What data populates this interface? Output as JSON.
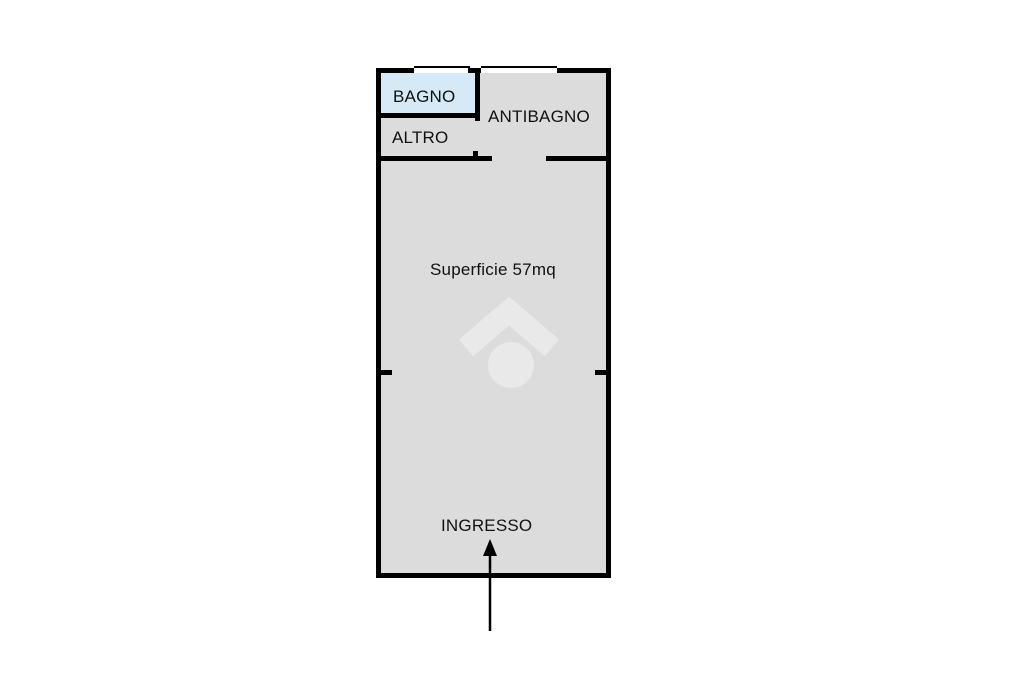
{
  "floorplan": {
    "labels": {
      "bagno": "BAGNO",
      "antibagno": "ANTIBAGNO",
      "altro": "ALTRO",
      "surface": "Superficie 57mq",
      "ingresso": "INGRESSO"
    },
    "surface_area_mq": 57,
    "colors": {
      "wall": "#000000",
      "floor": "#dcdcdc",
      "bagno_fill": "#d6e9f7",
      "watermark": "#e9e9e9",
      "text": "#111111",
      "background": "#ffffff"
    },
    "icons": {
      "entrance_arrow": "up-arrow",
      "watermark": "house-roof-circle-logo"
    }
  }
}
